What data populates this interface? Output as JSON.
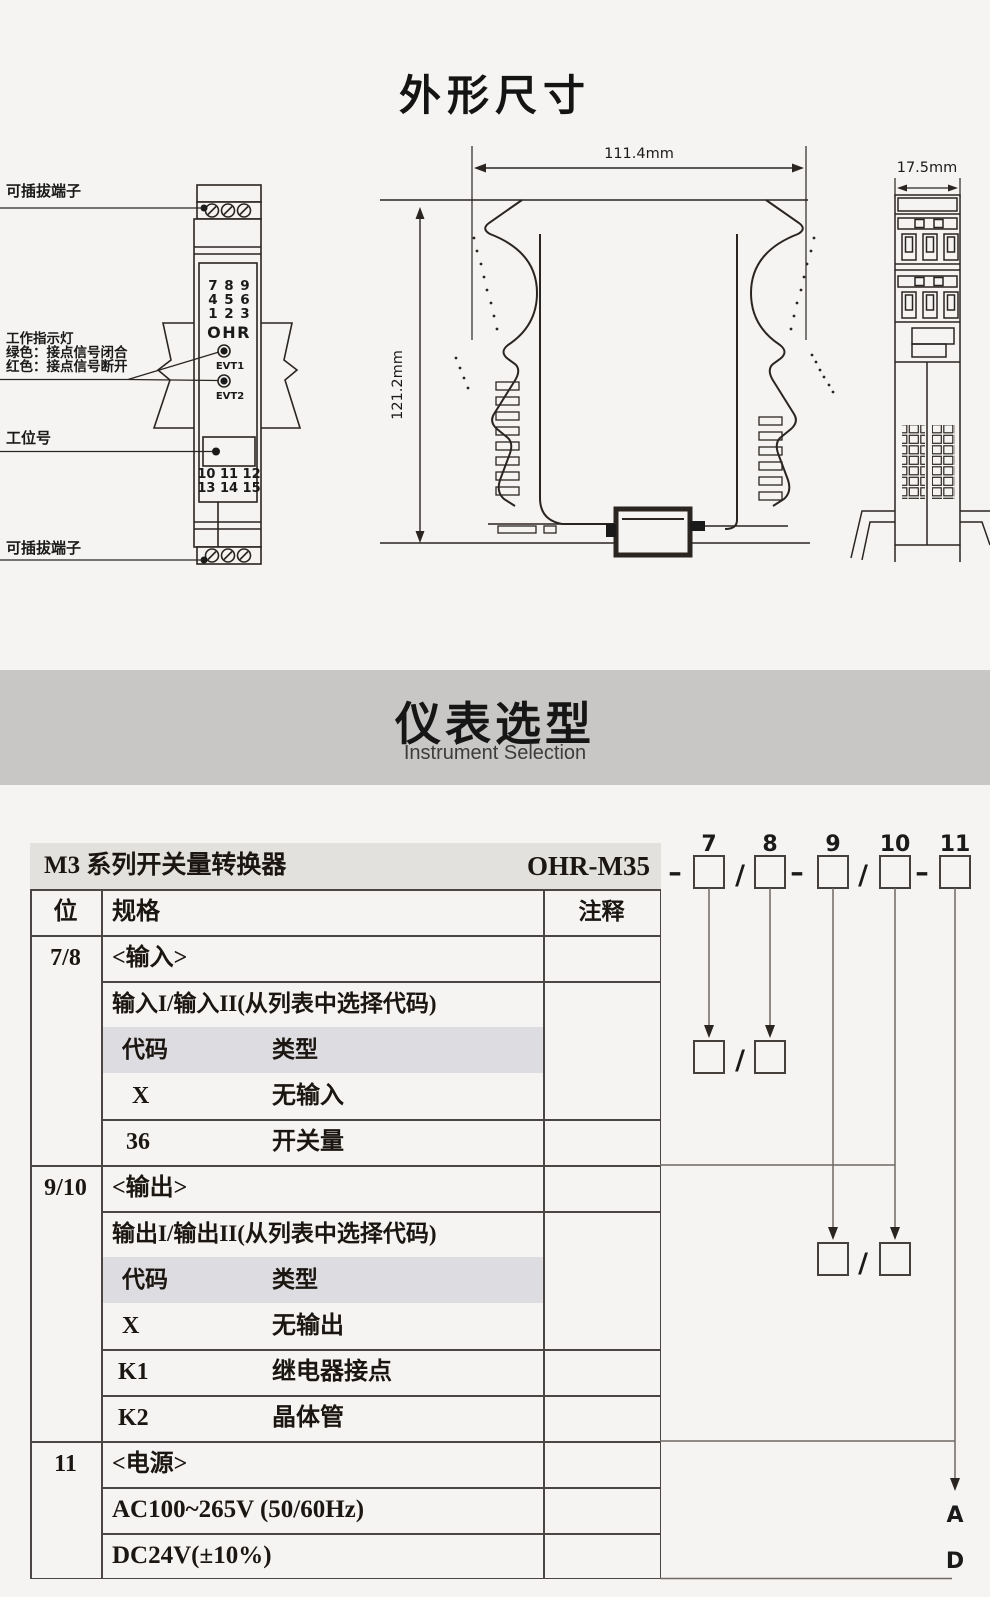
{
  "page": {
    "title": "外形尺寸"
  },
  "drawing": {
    "callouts": {
      "top_terminal": "可插拔端子",
      "indicator_title": "工作指示灯",
      "indicator_green": "绿色：接点信号闭合",
      "indicator_red": "红色：接点信号断开",
      "station": "工位号",
      "bottom_terminal": "可插拔端子"
    },
    "device": {
      "brand": "OHR",
      "led1": "EVT1",
      "led2": "EVT2",
      "grid": {
        "r1c1": "7",
        "r1c2": "8",
        "r1c3": "9",
        "r2c1": "4",
        "r2c2": "5",
        "r2c3": "6",
        "r3c1": "1",
        "r3c2": "2",
        "r3c3": "3"
      },
      "bottom_row1": "10 11 12",
      "bottom_row2": "13 14 15"
    },
    "dims": {
      "width": "111.4mm",
      "height": "121.2mm",
      "depth": "17.5mm"
    },
    "colors": {
      "red_digit": "#e03422",
      "line": "#2b2521"
    }
  },
  "selection": {
    "title": "仪表选型",
    "subtitle": "Instrument Selection"
  },
  "table": {
    "product": "M3 系列开关量转换器",
    "model": "OHR-M35",
    "col_pos": "位",
    "col_spec": "规格",
    "col_note": "注释",
    "input": {
      "pos": "7/8",
      "title": "<输入>",
      "subtitle": "输入I/输入II(从列表中选择代码)",
      "code_head": "代码",
      "type_head": "类型",
      "rows": [
        {
          "code": "X",
          "type": "无输入"
        },
        {
          "code": "36",
          "type": "开关量"
        }
      ]
    },
    "output": {
      "pos": "9/10",
      "title": "<输出>",
      "subtitle": "输出I/输出II(从列表中选择代码)",
      "code_head": "代码",
      "type_head": "类型",
      "rows": [
        {
          "code": "X",
          "type": "无输出"
        },
        {
          "code": "K1",
          "type": "继电器接点"
        },
        {
          "code": "K2",
          "type": "晶体管"
        }
      ]
    },
    "power": {
      "pos": "11",
      "title": "<电源>",
      "rows": [
        {
          "label": "AC100~265V (50/60Hz)",
          "code": "A"
        },
        {
          "label": "DC24V(±10%)",
          "code": "D"
        }
      ]
    }
  },
  "diagram": {
    "digits": [
      "7",
      "8",
      "9",
      "10",
      "11"
    ],
    "slash": "/",
    "dash": "–"
  }
}
